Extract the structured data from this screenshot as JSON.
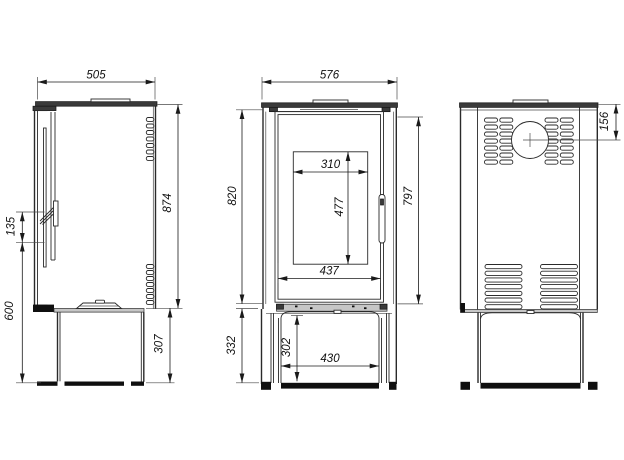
{
  "colors": {
    "background": "#ffffff",
    "line": "#2a2a2a",
    "plate_fill": "#3a3a3a",
    "band_fill": "#c6c6c6",
    "foot_fill": "#0f0f0f"
  },
  "views": {
    "side": {
      "dims": {
        "depth": "505",
        "body_height": "874",
        "handle_span": "135",
        "handle_to_floor": "600",
        "plinth_height": "307"
      }
    },
    "front": {
      "dims": {
        "width": "576",
        "glass_width": "310",
        "glass_height": "477",
        "glass_frame_width": "437",
        "body_height": "820",
        "door_height": "797",
        "plinth_height": "332",
        "niche_height": "302",
        "niche_width": "430"
      }
    },
    "back": {
      "dims": {
        "flue_center_from_top": "156"
      }
    }
  }
}
